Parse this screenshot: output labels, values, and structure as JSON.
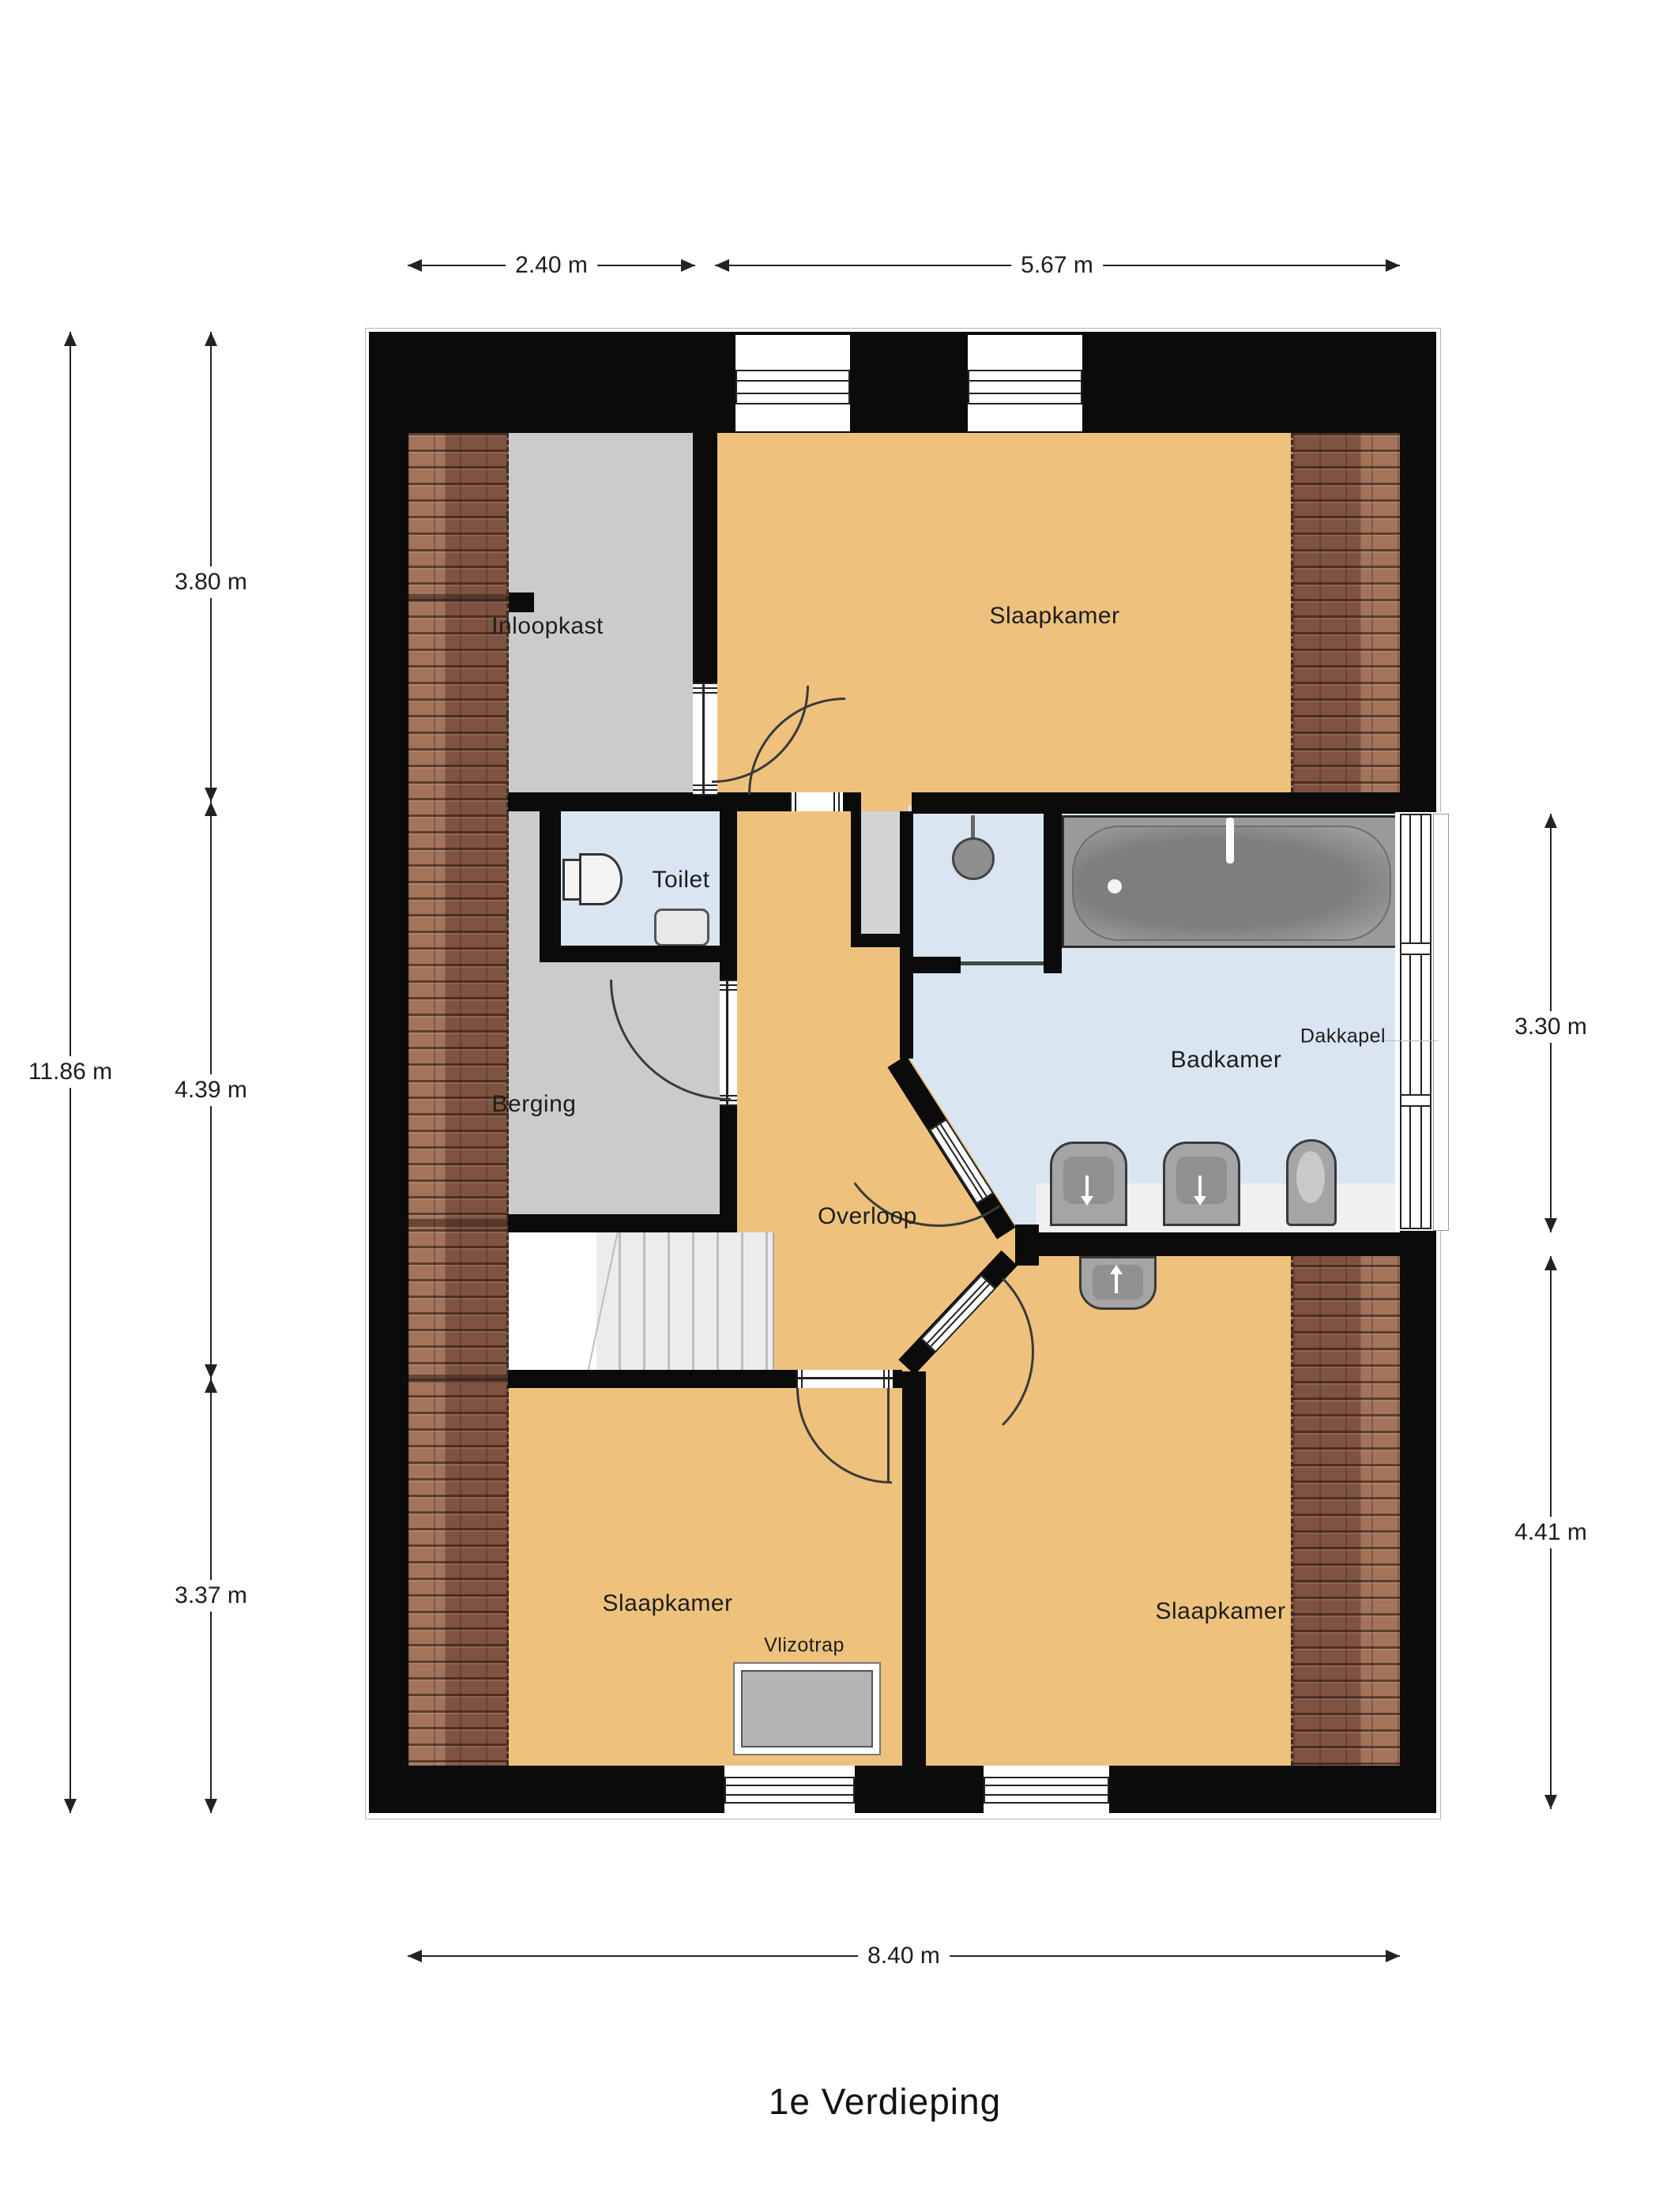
{
  "title": "1e Verdieping",
  "rooms": {
    "inloopkast": "Inloopkast",
    "slaapkamer_top": "Slaapkamer",
    "toilet": "Toilet",
    "berging": "Berging",
    "overloop": "Overloop",
    "badkamer": "Badkamer",
    "dakkapel": "Dakkapel",
    "slaapkamer_bl": "Slaapkamer",
    "slaapkamer_br": "Slaapkamer",
    "vlizotrap": "Vlizotrap"
  },
  "dimensions": {
    "top_left_width": "2.40 m",
    "top_right_width": "5.67 m",
    "total_height": "11.86 m",
    "left_top": "3.80 m",
    "left_middle": "4.39 m",
    "left_bottom": "3.37 m",
    "right_top": "3.30 m",
    "right_bottom": "4.41 m",
    "total_width": "8.40 m"
  },
  "colors": {
    "wall": "#0b0b0b",
    "floor_orange": "#eec27d",
    "floor_gray": "#cbcbcb",
    "floor_blue": "#d9e6f2",
    "roof_tile": "#8d5f49",
    "fixture_gray": "#a5a5a5",
    "stairs": "#ededed",
    "text": "#1d1d1d"
  }
}
